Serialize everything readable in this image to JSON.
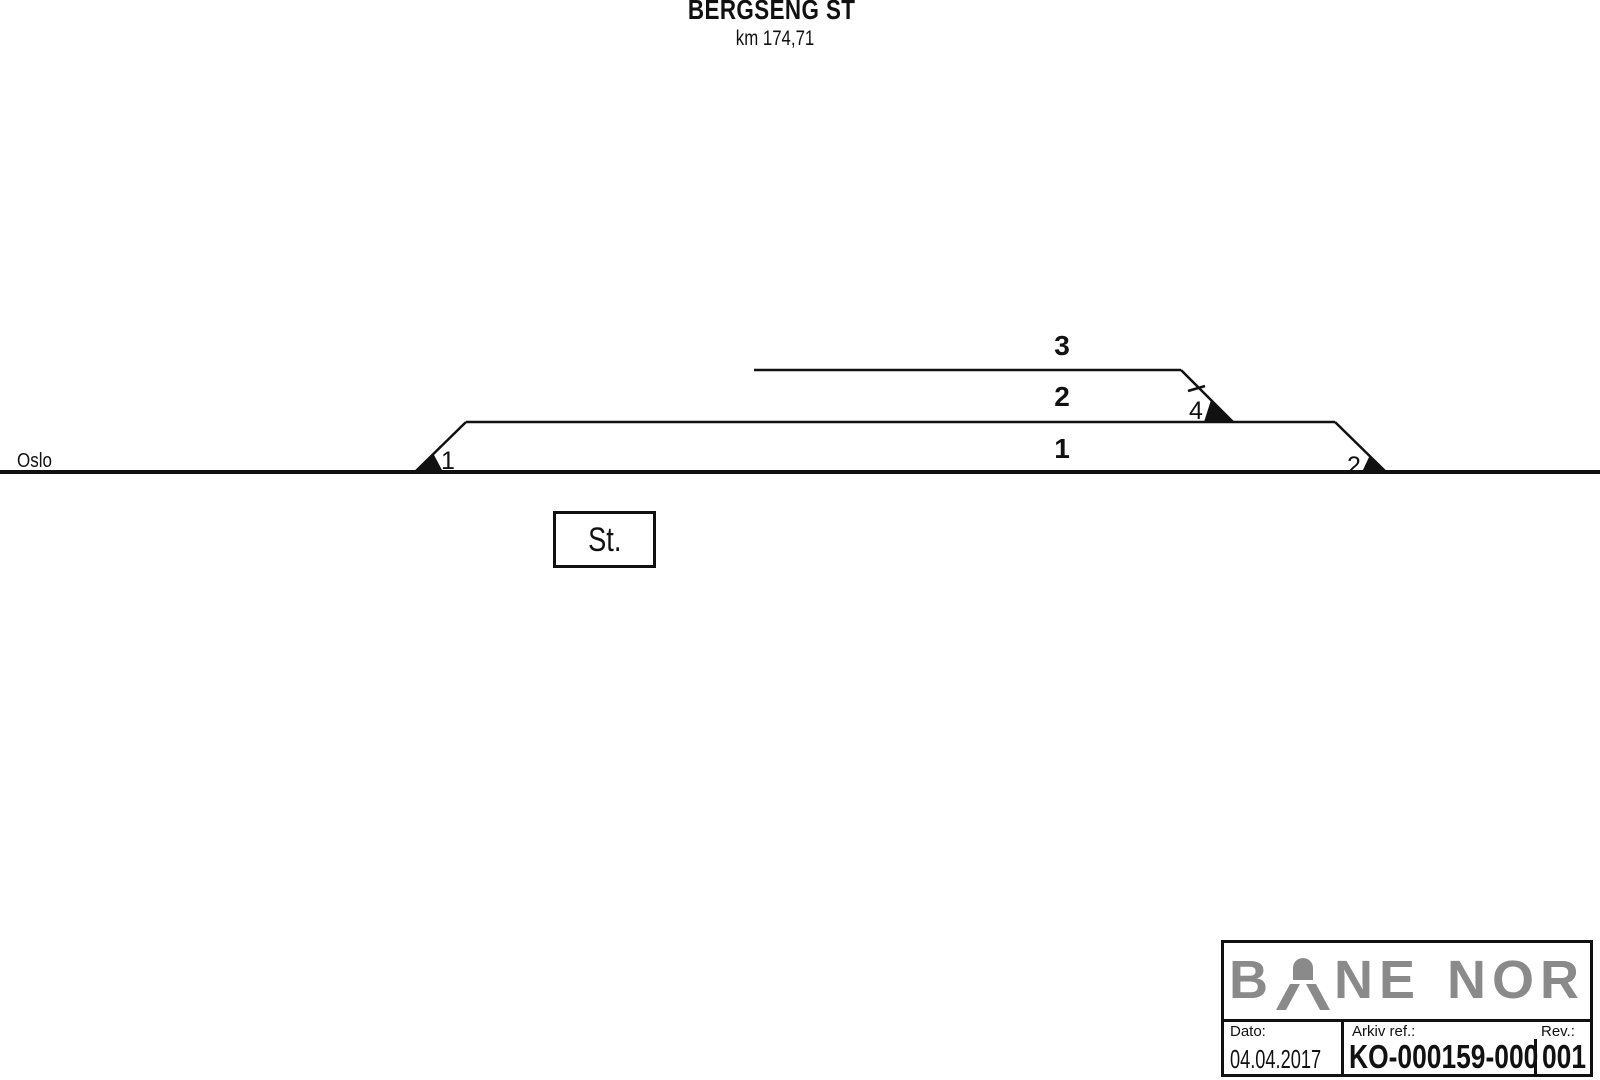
{
  "colors": {
    "line": "#111111",
    "logo_gray": "#8a8a8a",
    "background": "#ffffff"
  },
  "header": {
    "station_name": "BERGSENG ST",
    "kilometer": "km 174,71"
  },
  "diagram": {
    "origin_label": "Oslo",
    "station_box_label": "St.",
    "track_labels": [
      {
        "number": "3"
      },
      {
        "number": "2"
      },
      {
        "number": "1"
      }
    ],
    "switch_labels": [
      {
        "number": "1"
      },
      {
        "number": "2"
      },
      {
        "number": "4"
      }
    ]
  },
  "title_block": {
    "logo": {
      "part_b": "B",
      "part_ne": "NE",
      "part_nor": "NOR"
    },
    "date": {
      "label": "Dato:",
      "value": "04.04.2017"
    },
    "archive_ref": {
      "label": "Arkiv ref.:",
      "value": "KO-000159-000"
    },
    "revision": {
      "label": "Rev.:",
      "value": "001"
    }
  }
}
